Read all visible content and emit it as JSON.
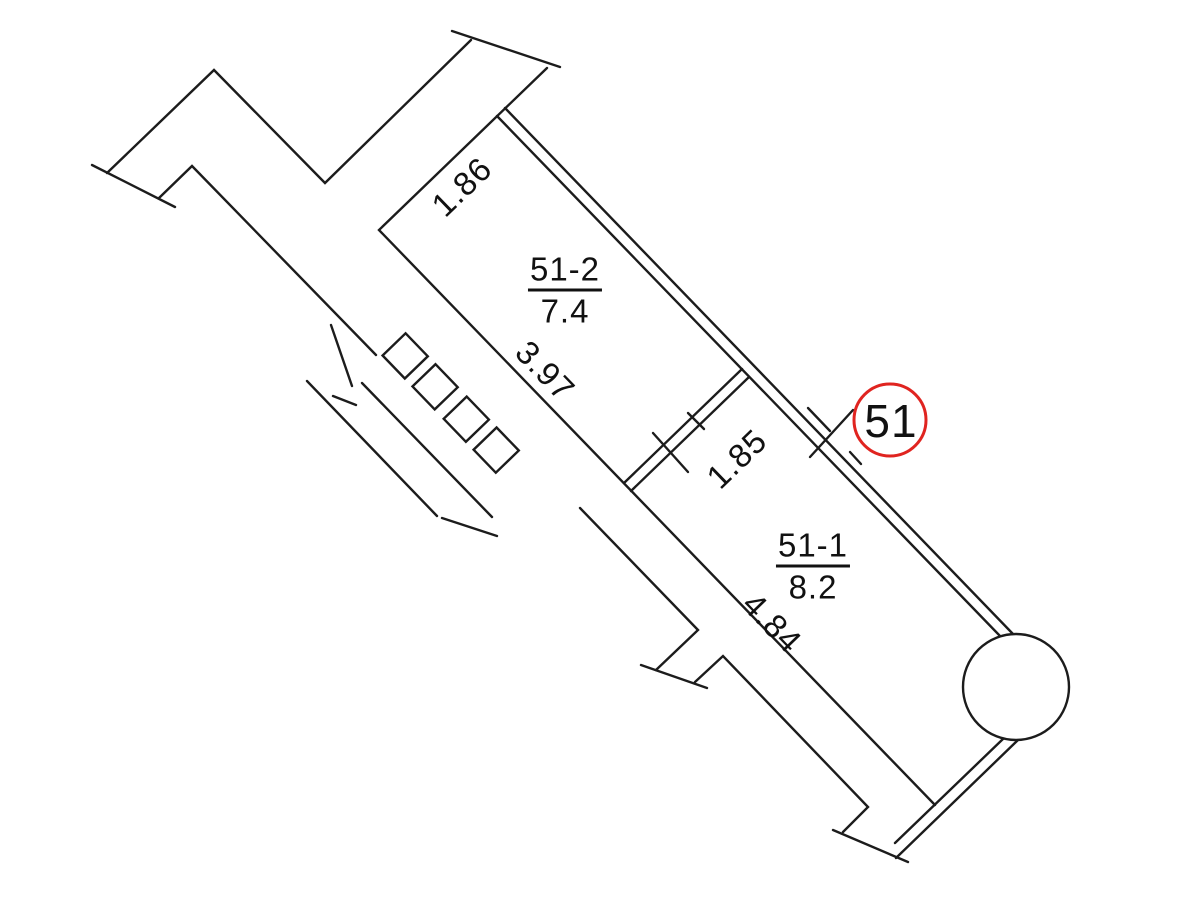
{
  "plan": {
    "type": "apartment floor plan fragment",
    "unit_badge": "51",
    "rooms": [
      {
        "number": "51-2",
        "area": "7.4"
      },
      {
        "number": "51-1",
        "area": "8.2"
      }
    ],
    "dimensions": {
      "room2_end_wall": "1.86",
      "room2_side_wall": "3.97",
      "corridor_width": "1.85",
      "room1_side_wall": "4.84"
    },
    "colors": {
      "wall": "#1c1c1c",
      "badge_ring": "#e02420",
      "text": "#111111"
    }
  }
}
